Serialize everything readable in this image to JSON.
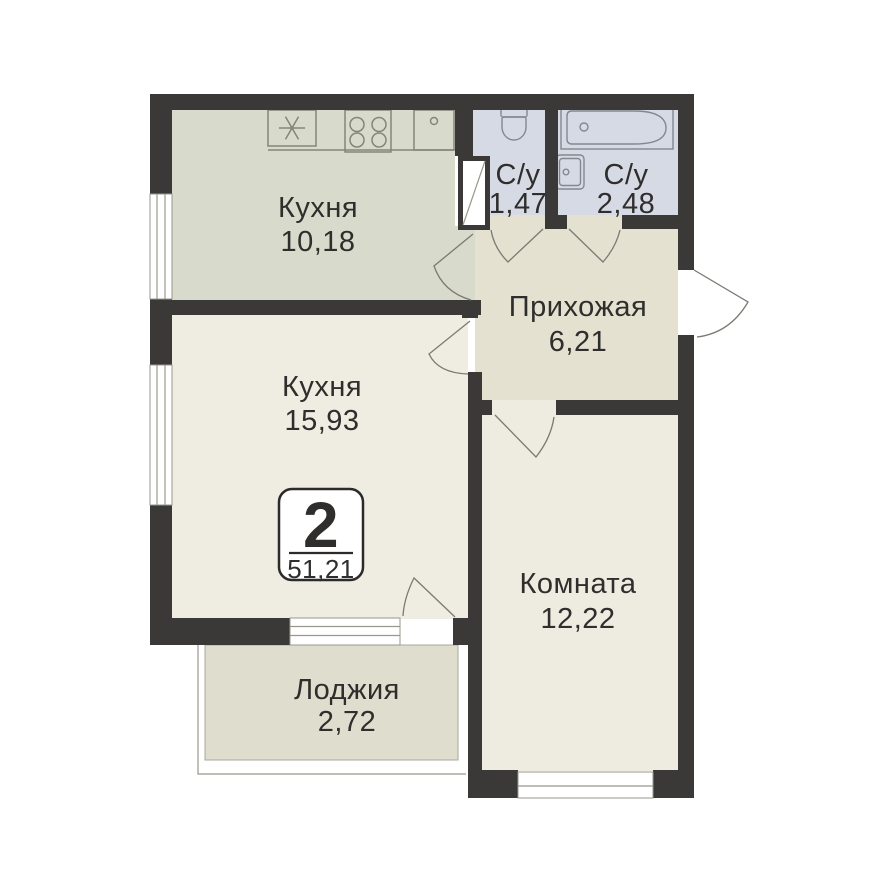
{
  "badge": {
    "rooms_count": "2",
    "total_area": "51,21"
  },
  "rooms": [
    {
      "id": "kitchen",
      "name": "Кухня",
      "area": "10,18"
    },
    {
      "id": "bathroom-small",
      "name": "С/у",
      "area": "1,47"
    },
    {
      "id": "bathroom-large",
      "name": "С/у",
      "area": "2,48"
    },
    {
      "id": "hallway",
      "name": "Прихожая",
      "area": "6,21"
    },
    {
      "id": "kitchen-living",
      "name": "Кухня",
      "area": "15,93"
    },
    {
      "id": "room",
      "name": "Комната",
      "area": "12,22"
    },
    {
      "id": "loggia",
      "name": "Лоджия",
      "area": "2,72"
    }
  ],
  "fixtures": [
    "fridge-icon",
    "stove-icon",
    "kitchen-sink-icon",
    "toilet-icon",
    "bathtub-icon",
    "washbasin-icon"
  ],
  "colors": {
    "wall": "#3b3938",
    "kitchen_floor": "#d8dbcc",
    "bathroom_floor": "#d6dae5",
    "hallway_floor": "#e4e1d1",
    "living_floor": "#efece2",
    "room_floor": "#eeebe1",
    "loggia_floor": "#dfddcd",
    "text": "#2f2e2c",
    "line": "#7b7972"
  }
}
